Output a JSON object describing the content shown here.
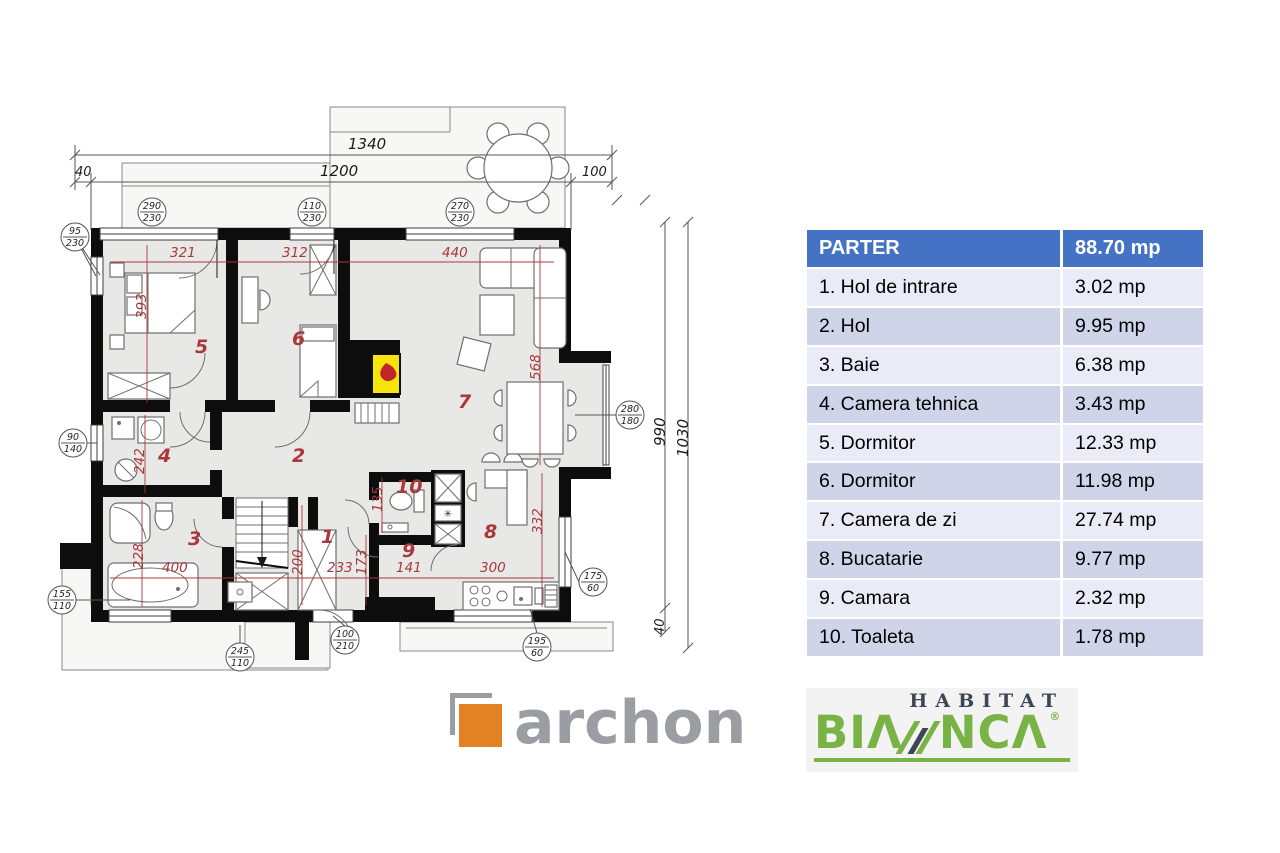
{
  "plan": {
    "dim_top_total": "1340",
    "dim_top_left": "40",
    "dim_top_mid": "1200",
    "dim_top_right": "100",
    "dim_right_inner": "990",
    "dim_right_outer": "1030",
    "dim_right_bottom": "40",
    "red_dims": {
      "r321": "321",
      "r312": "312",
      "r440": "440",
      "r393": "393",
      "r242": "242",
      "r228": "228",
      "r400": "400",
      "r200": "200",
      "r233": "233",
      "r173": "173",
      "r141": "141",
      "r135": "135",
      "r300": "300",
      "r568": "568",
      "r332": "332"
    },
    "rooms": {
      "n1": "1",
      "n2": "2",
      "n3": "3",
      "n4": "4",
      "n5": "5",
      "n6": "6",
      "n7": "7",
      "n8": "8",
      "n9": "9",
      "n10": "10"
    },
    "callouts": {
      "c290": {
        "w": "290",
        "h": "230"
      },
      "c110": {
        "w": "110",
        "h": "230"
      },
      "c270": {
        "w": "270",
        "h": "230"
      },
      "c95": {
        "w": "95",
        "h": "230"
      },
      "c90": {
        "w": "90",
        "h": "140"
      },
      "c155": {
        "w": "155",
        "h": "110"
      },
      "c245": {
        "w": "245",
        "h": "110"
      },
      "c100": {
        "w": "100",
        "h": "210"
      },
      "c195": {
        "w": "195",
        "h": "60"
      },
      "c175": {
        "w": "175",
        "h": "60"
      },
      "c280": {
        "w": "280",
        "h": "180"
      }
    },
    "icons": {
      "fridge": "✳"
    },
    "colors": {
      "dim_red": "#a8383c",
      "wall": "#0d0d0d",
      "fireplace_yellow": "#f6e50a"
    }
  },
  "table": {
    "header": {
      "label": "PARTER",
      "value": "88.70 mp"
    },
    "rows": [
      {
        "label": "1. Hol de intrare",
        "value": "3.02 mp"
      },
      {
        "label": "2. Hol",
        "value": "9.95 mp"
      },
      {
        "label": "3. Baie",
        "value": "6.38 mp"
      },
      {
        "label": "4. Camera tehnica",
        "value": "3.43 mp"
      },
      {
        "label": "5. Dormitor",
        "value": "12.33 mp"
      },
      {
        "label": "6. Dormitor",
        "value": "11.98 mp"
      },
      {
        "label": "7. Camera de zi",
        "value": "27.74 mp"
      },
      {
        "label": "8. Bucatarie",
        "value": "9.77 mp"
      },
      {
        "label": "9. Camara",
        "value": "2.32 mp"
      },
      {
        "label": "10. Toaleta",
        "value": "1.78 mp"
      }
    ],
    "colors": {
      "header_bg": "#4472c4",
      "row_odd": "#cfd4e9",
      "row_even": "#e9ebf6"
    }
  },
  "logos": {
    "archon": {
      "text": "archon",
      "orange": "#e28222",
      "gray": "#9a9da1"
    },
    "habitat_bianca": {
      "habitat": "HABITAT",
      "part1": "BI",
      "a1": "Λ",
      "part2": "NC",
      "a2": "Λ",
      "reg": "®",
      "green": "#79b345",
      "dark": "#3c4654"
    }
  }
}
